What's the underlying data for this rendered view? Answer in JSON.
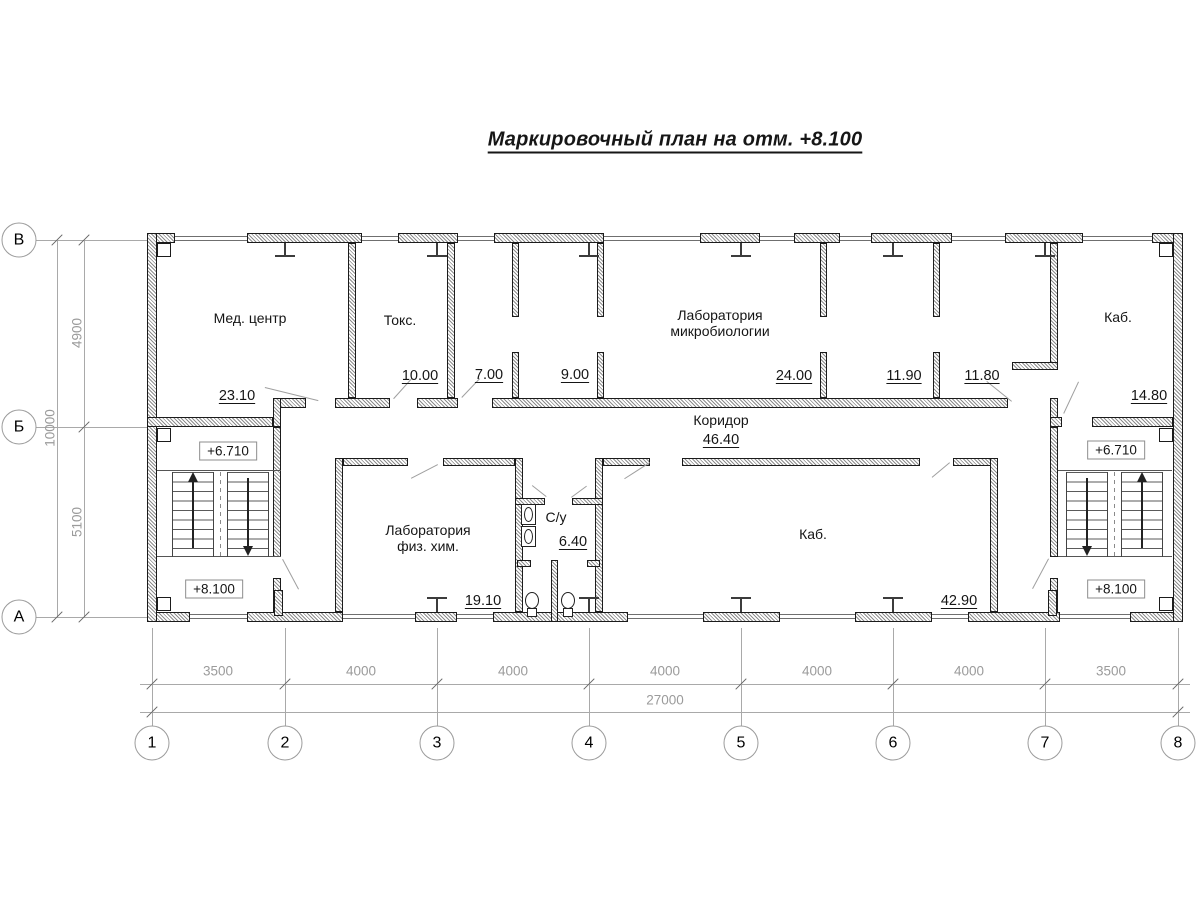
{
  "title": "Маркировочный план на отм. +8.100",
  "rooms": {
    "med_center": {
      "name": "Мед. центр",
      "area": "23.10"
    },
    "toks": {
      "name": "Токс.",
      "area": "10.00"
    },
    "r7": {
      "area": "7.00"
    },
    "r9": {
      "area": "9.00"
    },
    "microbio": {
      "name_line1": "Лаборатория",
      "name_line2": "микробиологии",
      "area": "24.00"
    },
    "r1190": {
      "area": "11.90"
    },
    "r1180": {
      "area": "11.80"
    },
    "kab_small": {
      "name": "Каб.",
      "area": "14.80"
    },
    "corridor": {
      "name": "Коридор",
      "area": "46.40"
    },
    "fizhim": {
      "name_line1": "Лаборатория",
      "name_line2": "физ. хим.",
      "area": "19.10"
    },
    "su": {
      "name": "С/у",
      "area": "6.40"
    },
    "kab_large": {
      "name": "Каб.",
      "area": "42.90"
    }
  },
  "levels": {
    "upper": "+6.710",
    "lower": "+8.100"
  },
  "axes": {
    "cols": [
      "1",
      "2",
      "3",
      "4",
      "5",
      "6",
      "7",
      "8"
    ],
    "rows": [
      "В",
      "Б",
      "А"
    ]
  },
  "dims": {
    "bottom": [
      "3500",
      "4000",
      "4000",
      "4000",
      "4000",
      "4000",
      "3500"
    ],
    "bottom_total": "27000",
    "left": [
      "4900",
      "5100"
    ],
    "left_total": "10000"
  },
  "colors": {
    "wall_outline": "#1b1b1b",
    "dim_gray": "#9b9b9b"
  }
}
